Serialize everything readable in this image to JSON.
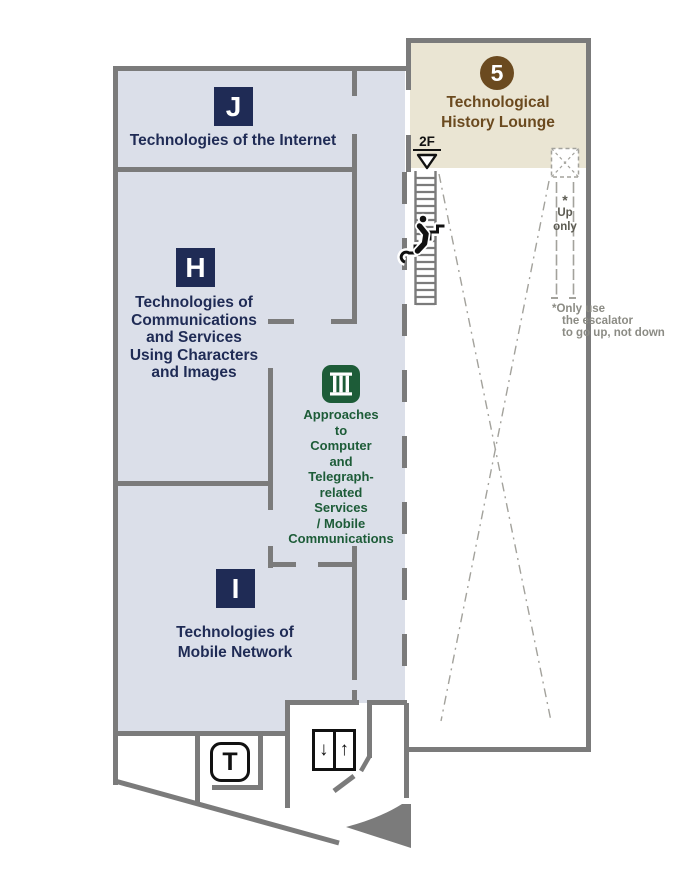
{
  "map": {
    "floor_label": "2F",
    "zones": {
      "j": {
        "letter": "J",
        "name": "Technologies of the Internet"
      },
      "h": {
        "letter": "H",
        "name": "Technologies of\nCommunications\nand Services\nUsing Characters\nand Images"
      },
      "iii": {
        "numeral": "III",
        "name": "Approaches\nto\nComputer\nand\nTelegraph-\nrelated\nServices\n/ Mobile\nCommunications"
      },
      "i": {
        "letter": "I",
        "name": "Technologies of\nMobile Network"
      }
    },
    "lounge": {
      "number": "5",
      "name": "Technological\nHistory Lounge"
    },
    "escalator": {
      "star": "*",
      "direction": "Up\nonly"
    },
    "footnote": "*Only use\nthe escalator\nto go up, not down",
    "facilities": {
      "toilet_label": "T",
      "elevator_down_arrow": "↓",
      "elevator_up_arrow": "↑"
    },
    "colors": {
      "zone_navy": "#1f2b55",
      "zone_green": "#1d5c38",
      "lounge_brown": "#6b4a1f",
      "lounge_bg": "#eae5d3",
      "floor_bg": "#dbdfe9",
      "wall_gray": "#7b7b7b",
      "dash_gray": "#a3a29c"
    }
  }
}
